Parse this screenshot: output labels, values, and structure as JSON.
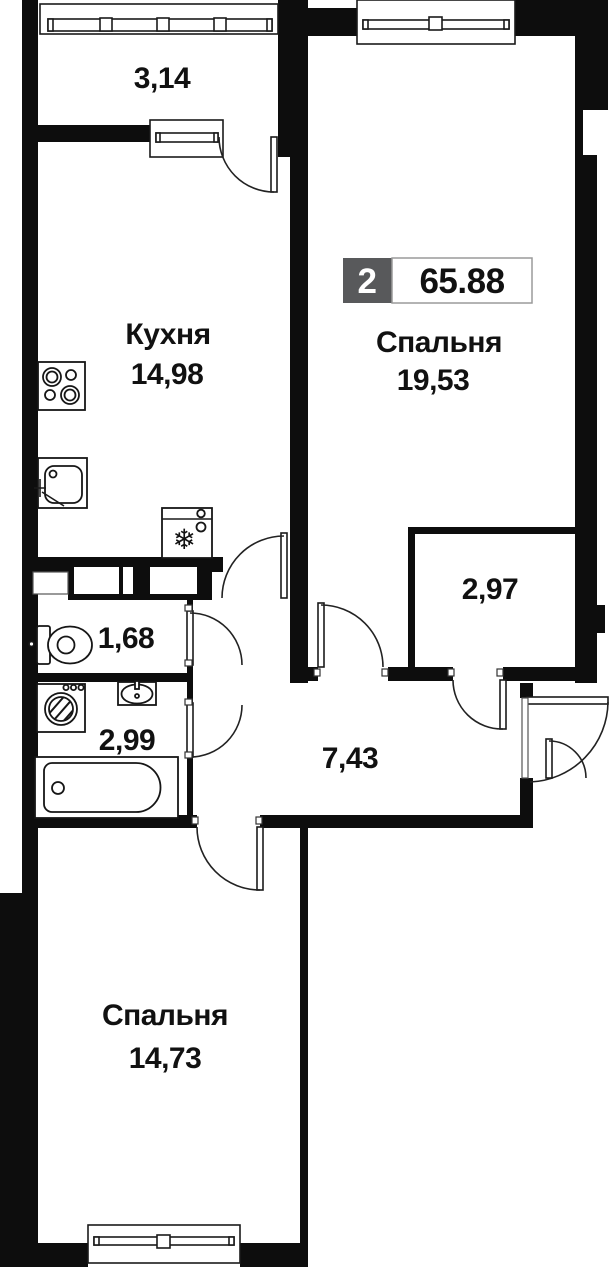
{
  "plan": {
    "type": "apartment-floor-plan",
    "badge": {
      "rooms_count": "2",
      "total_area": "65.88",
      "gray_color": "#58595B"
    },
    "rooms": [
      {
        "name": "",
        "area": "3,14",
        "kind": "balcony"
      },
      {
        "name": "Кухня",
        "area": "14,98",
        "kind": "kitchen"
      },
      {
        "name": "Спальня",
        "area": "19,53",
        "kind": "bedroom"
      },
      {
        "name": "",
        "area": "2,97",
        "kind": "closet"
      },
      {
        "name": "",
        "area": "1,68",
        "kind": "wc"
      },
      {
        "name": "",
        "area": "2,99",
        "kind": "bathroom"
      },
      {
        "name": "",
        "area": "7,43",
        "kind": "hallway"
      },
      {
        "name": "Спальня",
        "area": "14,73",
        "kind": "bedroom"
      }
    ],
    "icons": {
      "fridge_glyph": "❄"
    },
    "colors": {
      "wall": "#0d0d0d",
      "background": "#ffffff",
      "badge_gray": "#58595B",
      "line": "#222222"
    }
  }
}
